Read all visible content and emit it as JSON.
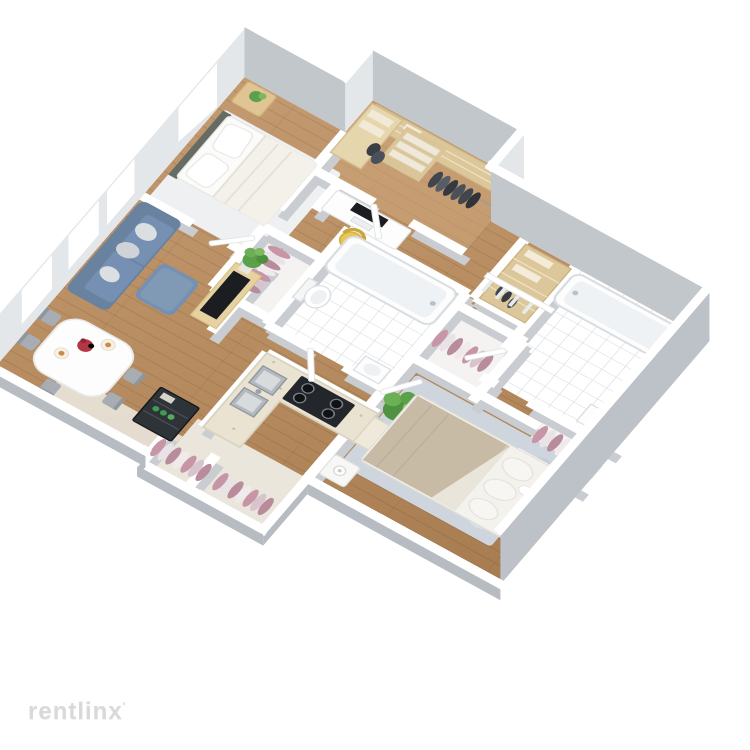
{
  "watermark": {
    "text": "rentlinx",
    "mark": "ʹ"
  },
  "scene": {
    "type": "3d-floor-plan",
    "style": "isometric dollhouse cutaway render of a 2-bedroom 2-bath apartment",
    "rooms": [
      {
        "name": "walk-in-closet-office",
        "furniture": [
          "wood-shelving",
          "storage-boxes",
          "dark-hanging-clothes",
          "corner-shelf-unit"
        ]
      },
      {
        "name": "bedroom-1",
        "furniture": [
          "double-bed-white",
          "two-pillows",
          "dark-headboard",
          "white-area-rug",
          "nightstand-with-plant"
        ]
      },
      {
        "name": "desk-nook",
        "furniture": [
          "white-desk",
          "monitor",
          "keyboard",
          "yellow-chair"
        ]
      },
      {
        "name": "bathroom-1",
        "furniture": [
          "bathtub",
          "toilet",
          "pedestal-sink",
          "tiled-floor"
        ]
      },
      {
        "name": "closet-left",
        "furniture": [
          "mauve-hanging-clothes",
          "clothes-rail"
        ]
      },
      {
        "name": "closet-right",
        "furniture": [
          "mauve-hanging-clothes",
          "clothes-rail"
        ]
      },
      {
        "name": "bathroom-2",
        "furniture": [
          "long-bathtub",
          "toilet",
          "vanity-sink",
          "side-cabinet",
          "tiled-floor"
        ]
      },
      {
        "name": "linen-closet",
        "furniture": [
          "wood-shelves",
          "folded-linens",
          "dark-shoes"
        ]
      },
      {
        "name": "living-room",
        "furniture": [
          "blue-sofa",
          "gray-throw-pillows",
          "blue-ottoman",
          "tv-stand",
          "tv",
          "potted-plant",
          "windows"
        ]
      },
      {
        "name": "dining-area",
        "furniture": [
          "white-dining-table",
          "five-gray-chairs",
          "red-flower-centerpiece",
          "plates"
        ]
      },
      {
        "name": "bar-cabinet",
        "furniture": [
          "dark-cabinet",
          "green-bottles"
        ]
      },
      {
        "name": "kitchen",
        "furniture": [
          "l-shaped-counter",
          "double-steel-sink",
          "black-gas-stove-4-burners",
          "large-potted-plant"
        ]
      },
      {
        "name": "master-bedroom",
        "furniture": [
          "double-bed-tan-blanket",
          "white-pillows",
          "blue-gray-rug",
          "nightstand-with-lamp",
          "headboard-nightstand"
        ]
      },
      {
        "name": "master-closet",
        "furniture": [
          "mauve-hanging-clothes"
        ]
      },
      {
        "name": "entry-hall",
        "furniture": [
          "two-closets-mauve-clothes",
          "front-door",
          "beige-carpet"
        ]
      },
      {
        "name": "stair-railing",
        "furniture": [
          "white-railing"
        ]
      }
    ]
  },
  "palette": {
    "bg": "#ffffff",
    "wall-top": "#ffffff",
    "wall-face-n": "#c2c7cc",
    "wall-face-e": "#bcc2c8",
    "wall-face-w": "#e4e7ea",
    "wall-face-near": "#b6bcc2",
    "wall-int-under": "#c9cdd1",
    "floor-wood-light": "#c59b72",
    "floor-wood-dark": "#a5794e",
    "floor-closet": "#cfa87c",
    "tile-grout": "#ccd2d7",
    "rug-white": "#eef0f1",
    "rug-master": "#ced5dd",
    "sofa": "#7590b2",
    "sofa-dark": "#68829f",
    "pillow-gray": "#d8dbde",
    "wood-furniture": "#e6d2a0",
    "shelf-wood": "#dcc79b",
    "tv-black": "#1b1d21",
    "plant-green": "#5da04a",
    "plant-green-light": "#7cb85e",
    "chair-yellow": "#e8c658",
    "table-white": "#fdfdfd",
    "chair-gray": "#a7adb3",
    "flower-red": "#b23644",
    "counter": "#eae3d2",
    "stove-black": "#23262a",
    "steel": "#b3b9bf",
    "bed-white": "#fbfbf9",
    "headboard": "#666b64",
    "blanket-tan": "#c7bba6",
    "clothes-mauve": "#c795a5",
    "clothes-mauve-light": "#e9e2e6",
    "clothes-dark": "#41464d",
    "cabinet-dark": "#2e3338",
    "bottle-green": "#3f9b4f",
    "watermark": "#d9d9d9"
  }
}
